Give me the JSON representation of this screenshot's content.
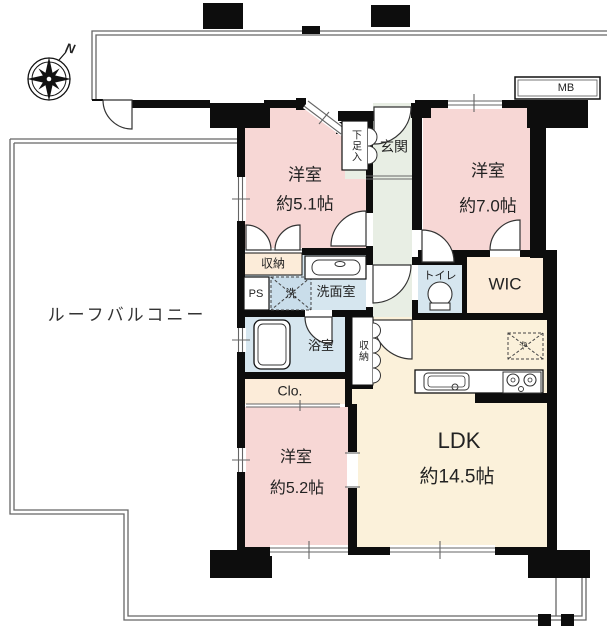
{
  "compass": {
    "north": "N"
  },
  "labels": {
    "roof_balcony": "ルーフバルコニー",
    "meter_box": "MB",
    "entrance": "玄関",
    "shoe_cabinet": "下足入",
    "upper_storage": "収納",
    "hallway_storage": "収納",
    "pipe_shaft": "PS",
    "washer": "洗",
    "washroom": "洗面室",
    "toilet": "トイレ",
    "wic": "WIC",
    "bath": "浴室",
    "closet": "Clo.",
    "refrigerator": "冷"
  },
  "rooms": {
    "bedroom_1": {
      "name": "洋室",
      "size": "約5.1帖"
    },
    "bedroom_2": {
      "name": "洋室",
      "size": "約7.0帖"
    },
    "bedroom_3": {
      "name": "洋室",
      "size": "約5.2帖"
    },
    "ldk": {
      "name": "LDK",
      "size": "約14.5帖"
    }
  },
  "colors": {
    "bedroom_pink": "#f7d7d5",
    "ldk_cream": "#fbf1da",
    "closet_cream": "#fcecd9",
    "hall_green": "#e8eee4",
    "wet_area_blue": "#d6e6ef",
    "wall_black": "#0d0d0d",
    "thin_line_gray": "#666666"
  }
}
